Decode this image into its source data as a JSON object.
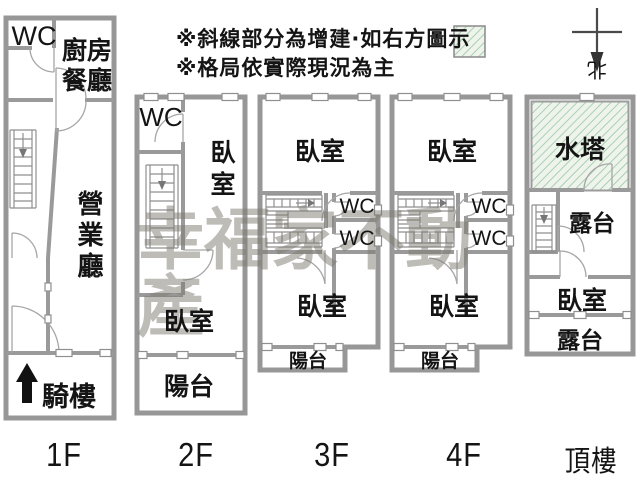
{
  "notes": {
    "line1": "※斜線部分為增建·如右方圖示",
    "line2": "※格局依實際現況為主"
  },
  "compass": {
    "north_label": "北"
  },
  "watermark": {
    "text": "幸福家不動產",
    "color": "#7d796f"
  },
  "colors": {
    "wall_gray": "#979797",
    "hatch_line_green": "#a9cfb0",
    "hatch_bg_green": "#eef4ec",
    "label_black": "#141414"
  },
  "floors": [
    {
      "label": "1F",
      "rooms": {
        "wc": "WC",
        "kitchen_dining_line1": "廚房",
        "kitchen_dining_line2": "餐廳",
        "business_hall": "營業廳",
        "arcade": "騎樓"
      }
    },
    {
      "label": "2F",
      "rooms": {
        "wc": "WC",
        "bedroom_upper": "臥室",
        "bedroom_lower": "臥室",
        "balcony": "陽台"
      }
    },
    {
      "label": "3F",
      "rooms": {
        "bedroom_upper": "臥室",
        "wc_upper": "WC",
        "wc_lower": "WC",
        "bedroom_lower": "臥室",
        "balcony": "陽台"
      }
    },
    {
      "label": "4F",
      "rooms": {
        "bedroom_upper": "臥室",
        "wc_upper": "WC",
        "wc_lower": "WC",
        "bedroom_lower": "臥室",
        "balcony": "陽台"
      }
    },
    {
      "label": "頂樓",
      "rooms": {
        "water_tower": "水塔",
        "terrace_upper": "露台",
        "bedroom": "臥室",
        "terrace_lower": "露台"
      }
    }
  ]
}
